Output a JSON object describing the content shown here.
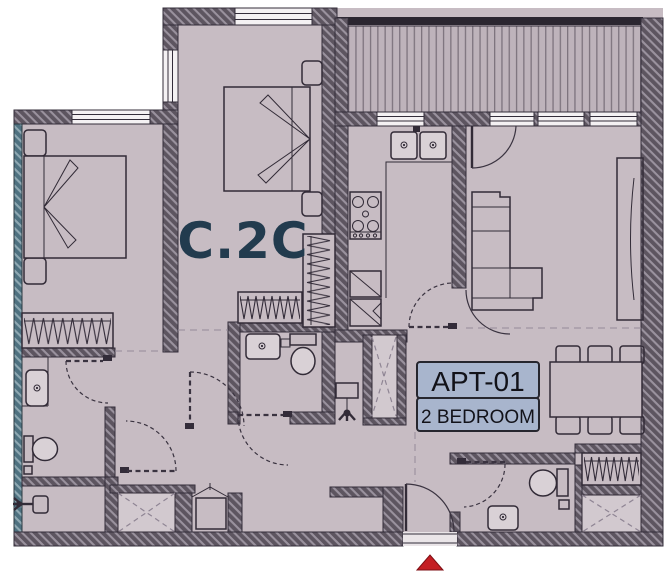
{
  "labels": {
    "unit_code": "C.2C",
    "apartment_id": "APT-01",
    "apartment_type": "2 BEDROOM"
  },
  "colors": {
    "background": "#ffffff",
    "floor": "#c7bcc3",
    "wall_base": "#5d5560",
    "wall_hatch": "#9a929e",
    "exterior_wall_base": "#4e7180",
    "exterior_wall_hatch": "#8fa9b3",
    "furniture_line": "#322b37",
    "fixture_fill": "#d9d1d6",
    "balcony_deck": "#beb3bb",
    "balcony_stripe": "#7d737e",
    "railing": "#2b2630",
    "window_fill": "#f4f1f3",
    "unit_code_text": "#223b4e",
    "label_box_fill": "#a8b5cd",
    "label_box_border": "#26262e",
    "label_text": "#121219",
    "entrance_marker": "#c41e23",
    "shaft_fill": "#d2c9cf"
  },
  "markers": {
    "entrance": "triangle-up"
  }
}
